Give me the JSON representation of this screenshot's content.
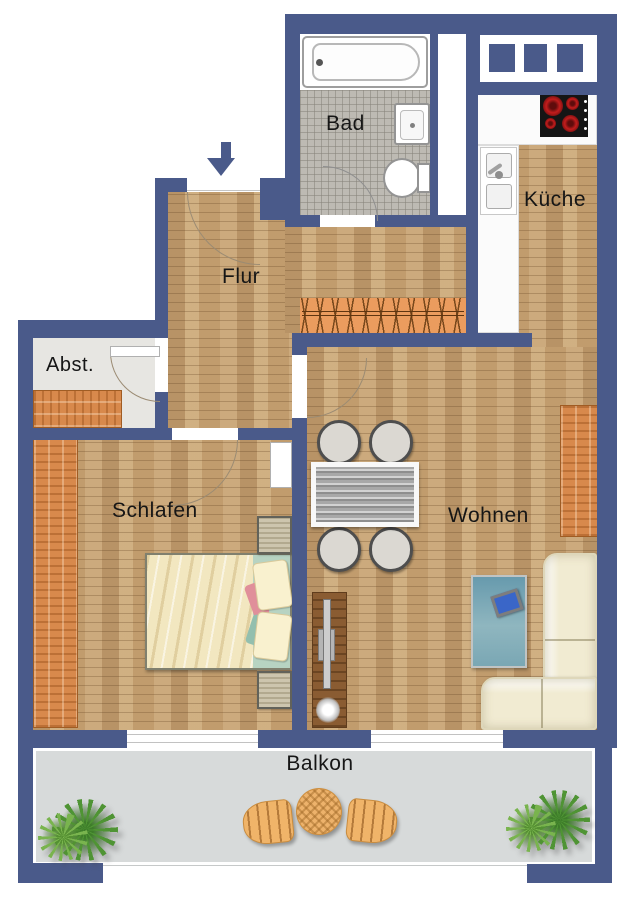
{
  "floorplan": {
    "rooms": {
      "bad": "Bad",
      "kueche": "Küche",
      "flur": "Flur",
      "abst": "Abst.",
      "schlafen": "Schlafen",
      "wohnen": "Wohnen",
      "balkon": "Balkon"
    },
    "entrance": {
      "direction": "down"
    },
    "fixtures": [
      "bathtub",
      "washbasin",
      "toilet",
      "kitchen-counter",
      "kitchen-sink",
      "stove-4-burners",
      "window-band",
      "coat-rack",
      "storage-shelf",
      "wardrobe",
      "double-bed",
      "nightstands",
      "dining-table",
      "four-chairs",
      "sideboard",
      "rug",
      "media-device",
      "corner-sofa",
      "tv-board",
      "balcony-round-table",
      "balcony-chairs",
      "potted-plants"
    ],
    "colors": {
      "wall": "#4a5a8a",
      "wood_floor": "#c9a77b",
      "accent_wood": "#d8894c",
      "bath_tile": "#bdbab3",
      "balcony_floor": "#d7dada",
      "stove_burner": "#c21d1d",
      "rug": "#6f9cab",
      "sofa": "#f1ebd2",
      "plant_green": "#4f9434"
    }
  }
}
